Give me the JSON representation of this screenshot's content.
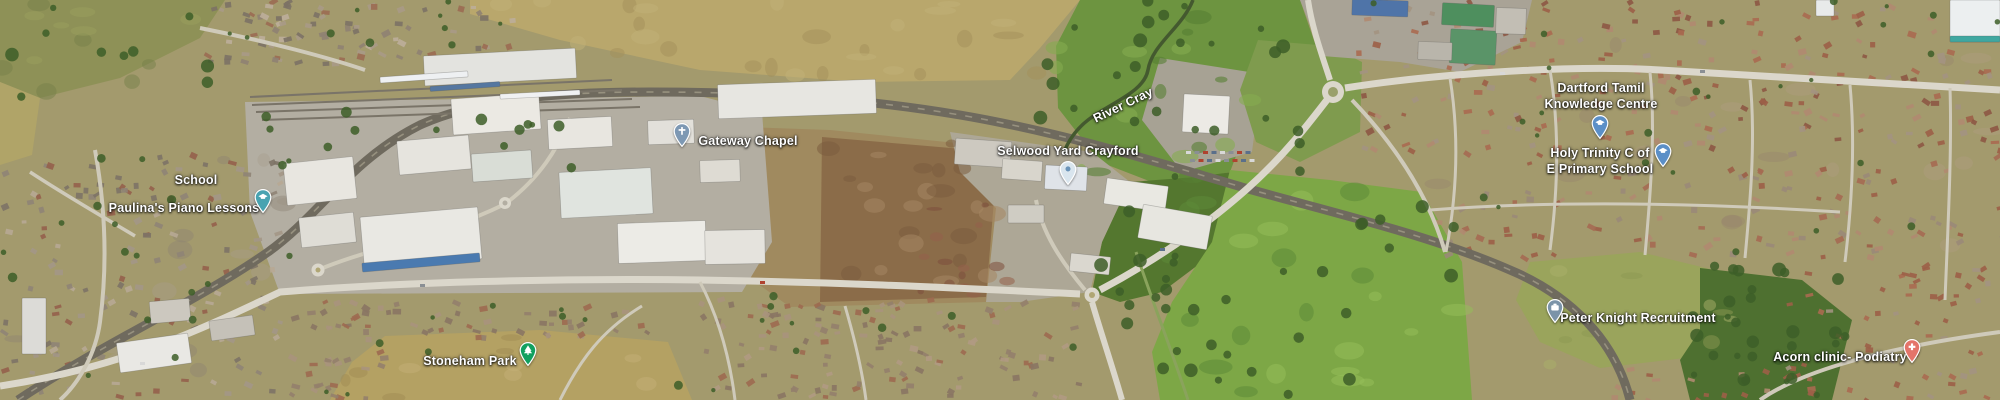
{
  "map": {
    "view_type": "satellite-aerial",
    "area_description": "Crayford / Dartford industrial estate, River Cray, railway sidings and surrounding residential streets",
    "pin_colors": {
      "education": "#5b8fc7",
      "lessons": "#49a3b1",
      "church": "#7d98b3",
      "generic": "#d9e5ee",
      "recruitment": "#7b93a8",
      "health": "#e4746a",
      "park": "#12a05f"
    },
    "labels": [
      {
        "id": "school",
        "text": "School",
        "x": 196,
        "y": 180,
        "interactable": false
      },
      {
        "id": "paulinas-piano-lessons",
        "text": "Paulina's Piano Lessons",
        "x": 184,
        "y": 208,
        "interactable": true,
        "pin": {
          "glyph": "education",
          "color_key": "lessons",
          "x": 263,
          "y": 218
        }
      },
      {
        "id": "gateway-chapel",
        "text": "Gateway Chapel",
        "x": 748,
        "y": 141,
        "interactable": true,
        "pin": {
          "glyph": "church",
          "color_key": "church",
          "x": 682,
          "y": 152
        }
      },
      {
        "id": "selwood-yard-crayford",
        "text": "Selwood Yard Crayford",
        "x": 1068,
        "y": 151,
        "interactable": true,
        "pin": {
          "glyph": "generic",
          "color_key": "generic",
          "x": 1068,
          "y": 190
        }
      },
      {
        "id": "river-cray",
        "text": "River Cray",
        "x": 1123,
        "y": 105,
        "rotation": -26,
        "interactable": false
      },
      {
        "id": "dartford-tamil-knowledge-centre",
        "lines": [
          "Dartford Tamil",
          "Knowledge Centre"
        ],
        "x": 1601,
        "y": 96,
        "interactable": true,
        "pin": {
          "glyph": "education",
          "color_key": "education",
          "x": 1600,
          "y": 144
        }
      },
      {
        "id": "holy-trinity-primary-school",
        "lines": [
          "Holy Trinity C of",
          "E Primary School"
        ],
        "x": 1600,
        "y": 161,
        "interactable": true,
        "pin": {
          "glyph": "education",
          "color_key": "education",
          "x": 1663,
          "y": 172
        }
      },
      {
        "id": "peter-knight-recruitment",
        "text": "Peter Knight Recruitment",
        "x": 1638,
        "y": 318,
        "interactable": true,
        "pin": {
          "glyph": "briefcase",
          "color_key": "recruitment",
          "x": 1555,
          "y": 328
        }
      },
      {
        "id": "acorn-clinic-podiatry",
        "text": "Acorn clinic- Podiatry",
        "x": 1840,
        "y": 357,
        "interactable": true,
        "pin": {
          "glyph": "health",
          "color_key": "health",
          "x": 1912,
          "y": 368
        }
      },
      {
        "id": "stoneham-park",
        "text": "Stoneham Park",
        "x": 470,
        "y": 361,
        "interactable": true,
        "pin": {
          "glyph": "tree",
          "color_key": "park",
          "x": 528,
          "y": 371
        }
      }
    ]
  }
}
